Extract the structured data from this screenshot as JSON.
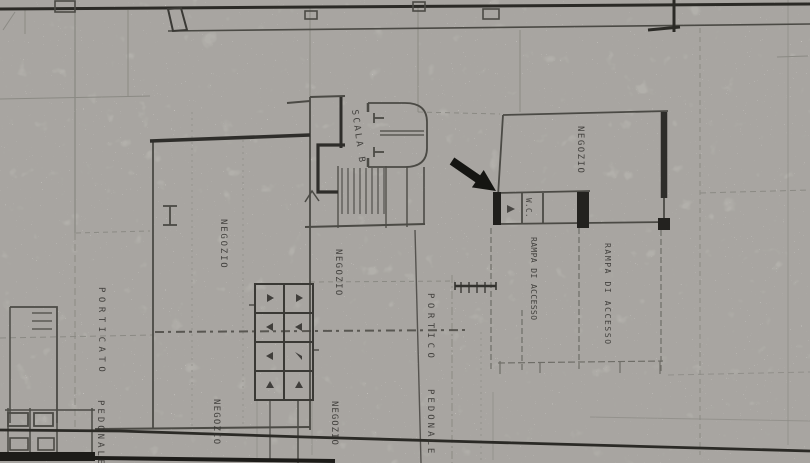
{
  "plan": {
    "labels": {
      "negozio_top_right": "NEGOZIO",
      "wc": "W.C.",
      "scala": "SCALA B",
      "negozio_left": "NEGOZIO",
      "negozio_center": "NEGOZIO",
      "negozio_bottom_left": "NEGOZIO",
      "negozio_bottom_center": "NEGOZIO",
      "porticato": "PORTICATO",
      "pedonale_left": "PEDONALE",
      "portico_center": "PORTICO",
      "pedonale_center": "PEDONALE",
      "rampa_access_left": "RAMPA DI ACCESSO",
      "rampa_access_right": "RAMPA DI ACCESSO"
    },
    "icons": {
      "arrow": "solid-black-arrow-pointing-lower-right"
    },
    "colors": {
      "paper": "#edebe6",
      "ink": "#1d1d1a",
      "wall": "#2e2d2a",
      "line": "#4b4a45",
      "faint": "#8b8a84",
      "arrow": "#151512"
    }
  }
}
